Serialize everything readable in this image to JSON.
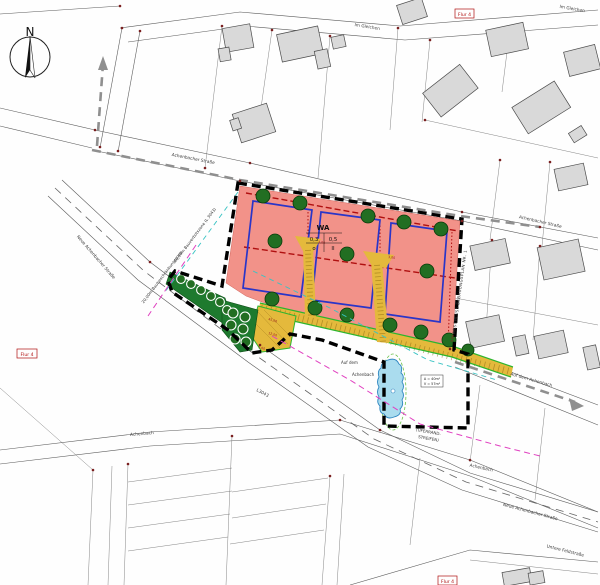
{
  "compass": {
    "north": "N"
  },
  "streets": {
    "im_gleichen_a": "Im Gleichen",
    "im_gleichen_b": "Im Gleichen",
    "achenbacher_a": "Achenbacher Straße",
    "achenbacher_b": "Achenbacher Straße",
    "neue_achenbacher_a": "Neue Achenbacher Straße",
    "neue_achenbacher_b": "Neue Achenbacher Straße",
    "achenbach_a": "Achenbach",
    "achenbach_b": "Achenbach",
    "untere_feldstrasse": "Untere Feldstraße",
    "auf_dem_achenbach": "Auf dem Achenbach",
    "auf_dem_line1": "Auf dem",
    "auf_dem_line2": "Achenbach",
    "l3043": "L3043"
  },
  "zoning": {
    "district": "WA",
    "grz": "0,3",
    "gfz": "0,5",
    "bauweise": "o",
    "vollgeschosse": "II"
  },
  "annotations": {
    "anschluss": "ANSCHLUSS BEBAUUNGSPLAN NR. 1",
    "bauverbotszone": "40,00m Bauverbotszone (L 3043)",
    "baubeschraenkungszone": "20,00m Baubeschränkungszone",
    "uferrandstreifen_1": "(UFERRAND-",
    "uferrandstreifen_2": "STREIFEN)",
    "basin_area": "A = 40m²",
    "basin_volume": "V = 57m³",
    "flur_top": "Flur 4",
    "flur_left": "Flur 4",
    "flur_bottom": "Flur 4"
  },
  "dimensions": [
    "3,00",
    "3,00",
    "45,00",
    "12,00",
    "5,00",
    "5,00"
  ],
  "colors": {
    "zone_fill": "#f29289",
    "envelope": "#2a35c8",
    "tree": "#226e22",
    "road_fill": "#e4b93c",
    "green_area": "#1e7a2e",
    "pond": "#aadcee",
    "boundary": "#000000",
    "accent_red": "#b01010",
    "gray_route": "#8f8f8f",
    "magenta": "#e040c0",
    "cyan": "#39c3c3"
  }
}
